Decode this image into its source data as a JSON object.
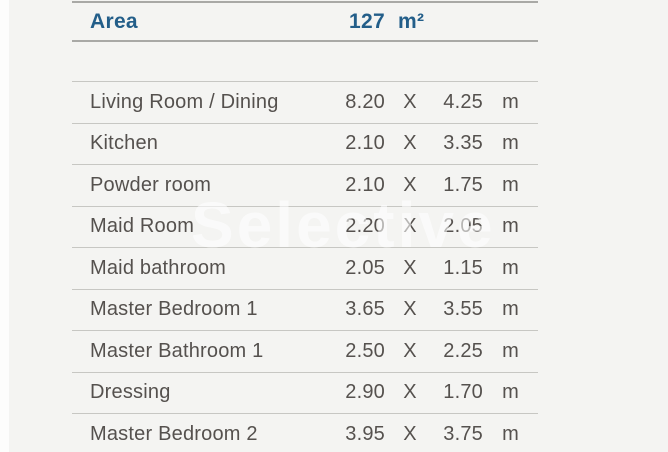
{
  "watermark": {
    "text": "Selective"
  },
  "table": {
    "header": {
      "area_label": "Area",
      "total_value": "127",
      "unit_label": "m²"
    },
    "times_label": "X",
    "row_unit_label": "m",
    "rows": [
      {
        "name": "Living Room / Dining",
        "width": "8.20",
        "height": "4.25"
      },
      {
        "name": "Kitchen",
        "width": "2.10",
        "height": "3.35"
      },
      {
        "name": "Powder room",
        "width": "2.10",
        "height": "1.75"
      },
      {
        "name": "Maid Room",
        "width": "2.20",
        "height": "2.05"
      },
      {
        "name": "Maid bathroom",
        "width": "2.05",
        "height": "1.15"
      },
      {
        "name": "Master Bedroom 1",
        "width": "3.65",
        "height": "3.55"
      },
      {
        "name": "Master Bathroom 1",
        "width": "2.50",
        "height": "2.25"
      },
      {
        "name": "Dressing",
        "width": "2.90",
        "height": "1.70"
      },
      {
        "name": "Master Bedroom 2",
        "width": "3.95",
        "height": "3.75"
      }
    ]
  },
  "colors": {
    "header_text": "#235e89",
    "body_text": "#55514e",
    "background": "#f4f4f2",
    "rule_light": "#c7c7c3",
    "rule_dark": "#a9a9a6"
  }
}
